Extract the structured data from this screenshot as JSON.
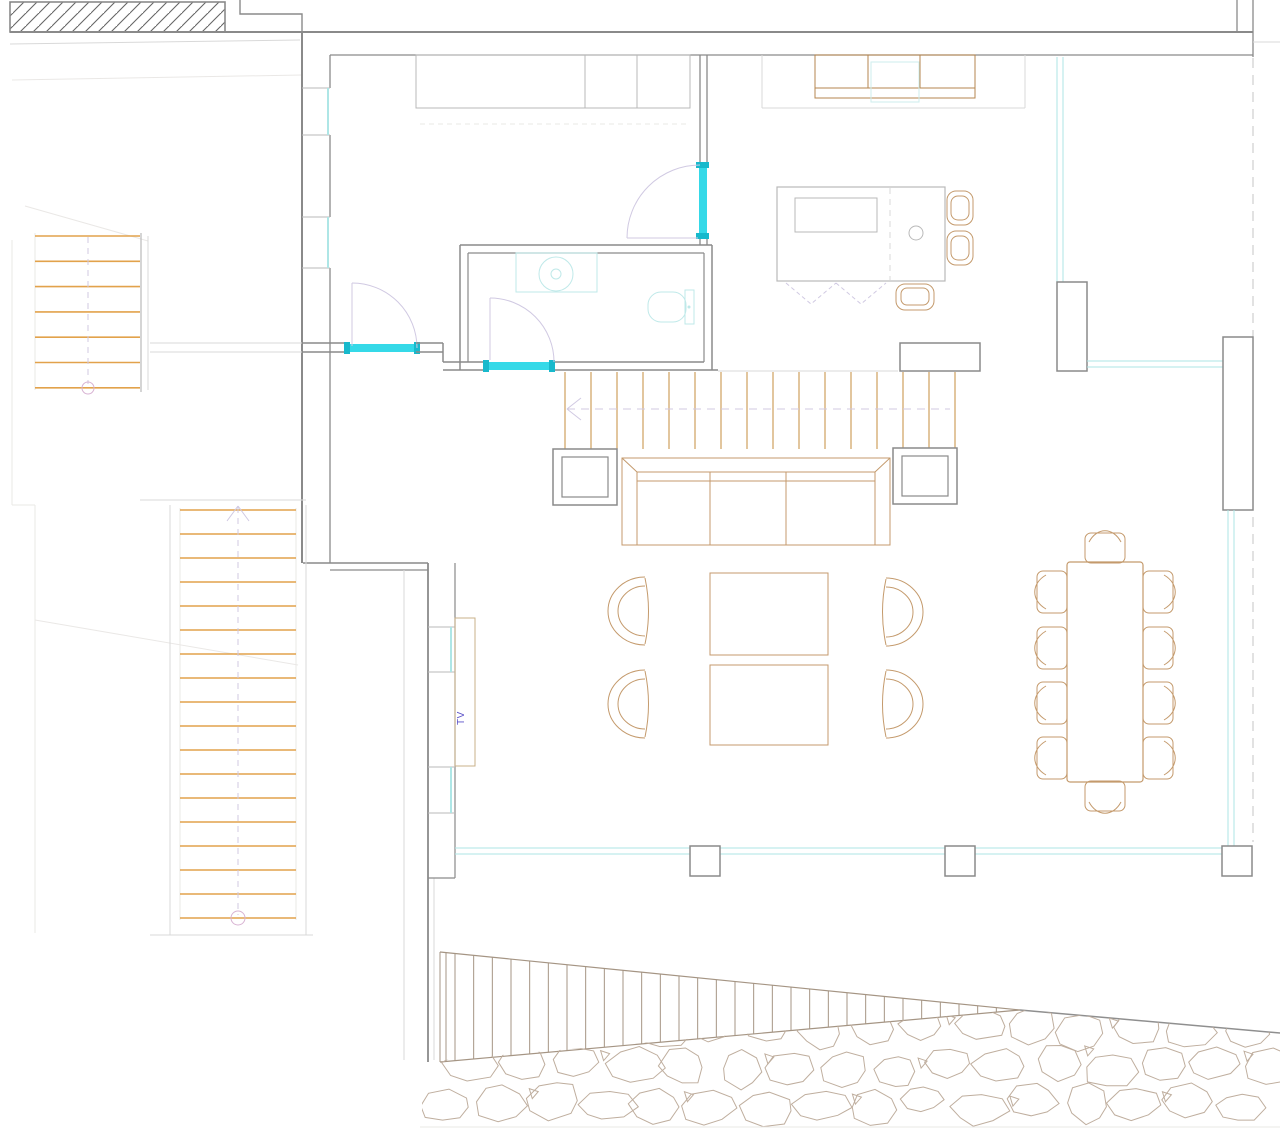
{
  "app": {
    "title": "Residential floor plan CAD drawing",
    "background": "#ffffff"
  },
  "labels": {
    "tv": "TV"
  },
  "colors": {
    "wall": "#8a8a8a",
    "wall_light": "#b9b9b9",
    "line_faint": "#d9d9d9",
    "line_vfaint": "#eae8e6",
    "furniture_tan": "#c49a6c",
    "cabinet_tan": "#b5854f",
    "tread_orange": "#e2a24b",
    "glass_cyan": "#aee6e6",
    "door_cyan": "#35d9e8",
    "door_cyan_dark": "#18b9cc",
    "fixture_cyan": "#bfe9e9",
    "centerline_lavender": "#d0c9e2",
    "stair_circle_pink": "#d8b3d3",
    "tv_text_blue": "#5b51c8",
    "deck_slat": "#a59584",
    "stone_outline": "#bfae9e",
    "hatch": "#666666"
  },
  "elements": {
    "upper_stair": {
      "treads": 7
    },
    "main_stair": {
      "treads": 18
    },
    "bridge": {
      "slats": 16
    },
    "deck_ramp": {
      "slats": 30
    },
    "dining": {
      "chairs": 10
    },
    "living": {
      "armchairs": 4,
      "coffee_tables": 2
    },
    "kitchen": {
      "bar_stools": 3
    },
    "stones": {
      "rows": 3,
      "per_row": 16
    }
  }
}
